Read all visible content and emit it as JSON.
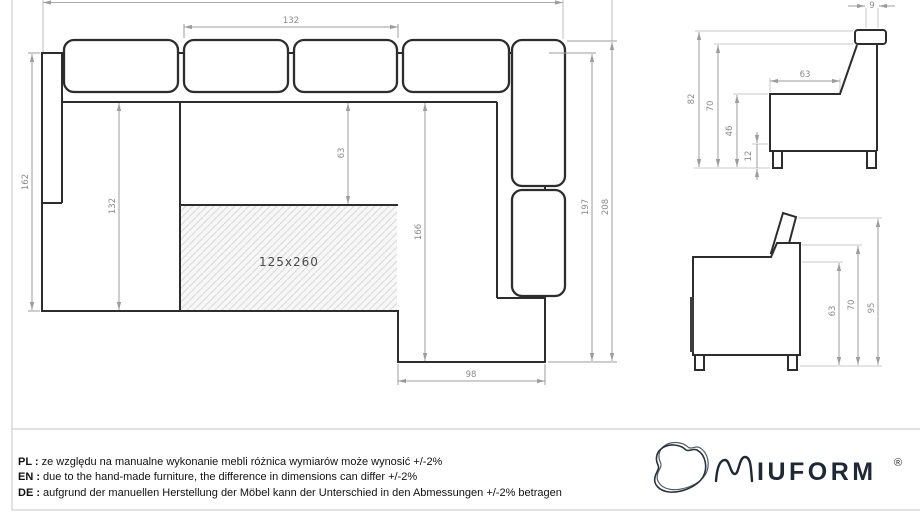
{
  "colors": {
    "drawing_line": "#2d2d2d",
    "dimension_line": "#9c9c9c",
    "dimension_text": "#8a8a8a",
    "hatch_line": "#d9d9d9",
    "frame_line": "#c5c5c5",
    "brand": "#1c2a38"
  },
  "top_view": {
    "sleep_area_label": "125x260",
    "dims": {
      "seat_width_top": "132",
      "left_section_depth": "162",
      "left_section_length": "132",
      "seat_depth": "63",
      "right_section_length": "166",
      "right_section_width": "98",
      "right_section_depth": "197",
      "right_section_total": "208"
    }
  },
  "side_view_upper": {
    "dims": {
      "total_height": "82",
      "backrest_height": "70",
      "seat_height": "46",
      "leg_height": "12",
      "seat_depth": "63",
      "back_top_width": "9"
    }
  },
  "side_view_lower": {
    "dims": {
      "armrest_height": "63",
      "backrest_height": "70",
      "headrest_height": "95"
    }
  },
  "notes": [
    {
      "label": "PL :",
      "text": "ze względu na manualne wykonanie mebli różnica wymiarów może wynosić +/-2%"
    },
    {
      "label": "EN :",
      "text": "due to the hand-made furniture, the difference in dimensions can differ +/-2%"
    },
    {
      "label": "DE :",
      "text": "aufgrund der manuellen Herstellung der Möbel kann der Unterschied in den Abmessungen +/-2% betragen"
    }
  ],
  "logo": {
    "brand": "IUFORM",
    "registered": "®"
  }
}
